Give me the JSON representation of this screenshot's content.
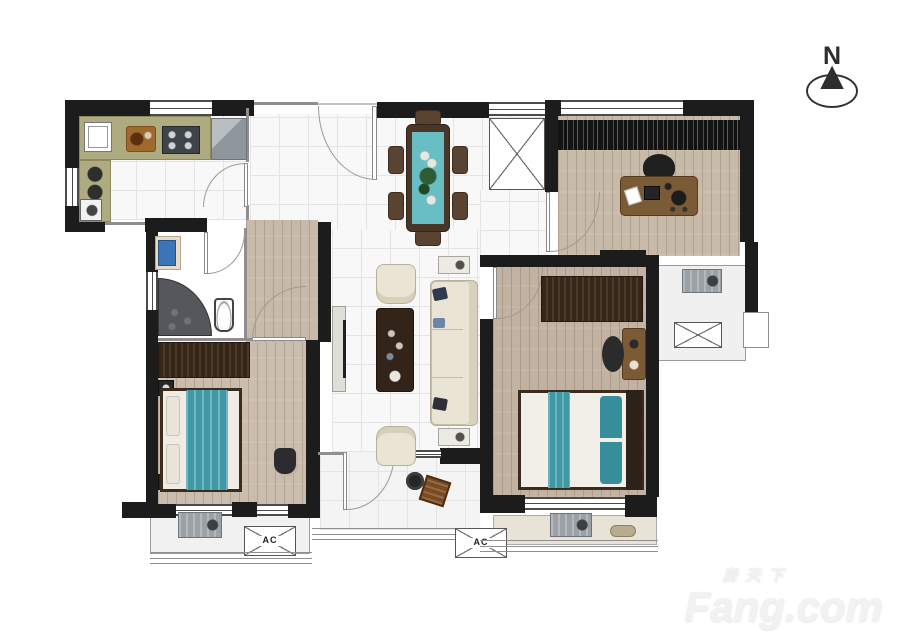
{
  "compass": {
    "label": "N"
  },
  "icons": {
    "north_arrow": "▲"
  },
  "labels": {
    "ac": "AC"
  },
  "watermark": {
    "brand_cn": "房天下",
    "brand_en": "Fang.com"
  },
  "colors": {
    "wall": "#1c1c1c",
    "tile": "#f8f8f9",
    "grid": "#e4e4e8",
    "wood": "#c8baa9",
    "wood_bedroom": "#cbbdad",
    "wood_master": "#c2b2a1",
    "teal": "#3f98a5",
    "teal_light": "#68bec3",
    "counter": "#aeab81",
    "furniture_brown": "#4a3626",
    "wardrobe_brown": "#35261a",
    "sofa_cream": "#eae4d4",
    "appliance_gray": "#9ba1a6",
    "curtain_black": "#141414",
    "outline_gray": "#8f8f8f",
    "sink_blue": "#3b76b8",
    "watermark_gray": "#f3f2f3"
  }
}
